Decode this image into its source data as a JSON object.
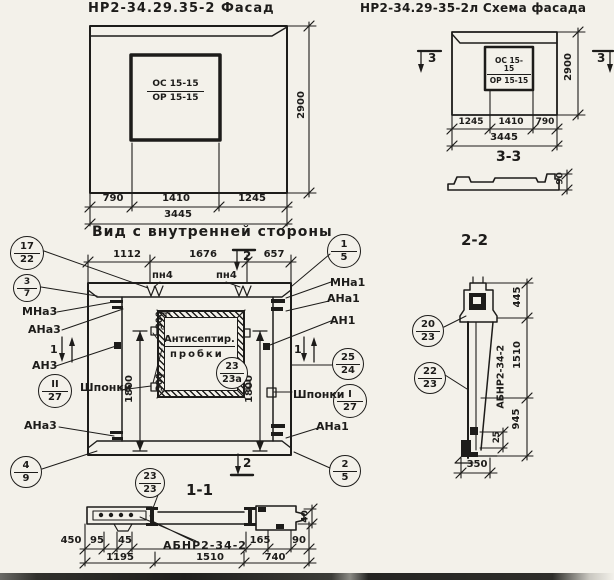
{
  "facade_view": {
    "title": "НР2-34.29.35-2 Фасад",
    "window_mark_top": "ОС 15-15",
    "window_mark_bottom": "ОР 15-15",
    "dim_height": "2900",
    "dims": [
      "790",
      "1410",
      "1245"
    ],
    "dim_total": "3445",
    "caption": "Вид с внутренней стороны"
  },
  "schema_view": {
    "title": "НР2-34.29-35-2л Схема фасада",
    "window_mark_top": "ОС 15-15",
    "window_mark_bottom": "ОР 15-15",
    "dim_height": "2900",
    "dims": [
      "1245",
      "1410",
      "790"
    ],
    "dim_total": "3445",
    "section_mark": "3",
    "section_title": "3-3",
    "section_thickness": "90"
  },
  "main_view": {
    "top_dims": [
      "1112",
      "1676",
      "657"
    ],
    "section_mark_2": "2",
    "section_mark_1": "1",
    "anchor_pn4": "пн4",
    "note_line1": "Антисептир.",
    "note_line2": "пробки",
    "dim_plug_top": "300",
    "dim_plug_bottom": "300",
    "dim_side_left": "1800",
    "dim_side_right": "1800",
    "label_mna3": "МНа3",
    "label_ana3_top": "АНа3",
    "label_an3": "АН3",
    "label_shponki_left": "Шпонки",
    "label_ana3_bottom": "АНа3",
    "label_mna1": "МНа1",
    "label_ana1_top": "АНа1",
    "label_an1": "АН1",
    "label_shponki_right": "Шпонки",
    "label_ana1_bottom": "АНа1",
    "section_title": "1-1"
  },
  "callouts": {
    "c17_22": {
      "top": "17",
      "bottom": "22"
    },
    "c3_7": {
      "top": "3",
      "bottom": "7"
    },
    "c2_27": {
      "top": "II",
      "bottom": "27"
    },
    "c4_9": {
      "top": "4",
      "bottom": "9"
    },
    "c1_5": {
      "top": "1",
      "bottom": "5"
    },
    "c25_24": {
      "top": "25",
      "bottom": "24"
    },
    "c1_27": {
      "top": "I",
      "bottom": "27"
    },
    "c2_5": {
      "top": "2",
      "bottom": "5"
    },
    "c23_23a": {
      "top": "23",
      "bottom": "23а"
    },
    "c23_23": {
      "top": "23",
      "bottom": "23"
    },
    "c20_23": {
      "top": "20",
      "bottom": "23"
    },
    "c22_23": {
      "top": "22",
      "bottom": "23"
    }
  },
  "section_1_1": {
    "dim_450": "450",
    "dim_95": "95",
    "dim_45": "45",
    "dim_165": "165",
    "dim_90": "90",
    "dim_40": "40",
    "beam_label": "АБНР2-34-2",
    "dims_bottom": [
      "1195",
      "1510",
      "740"
    ]
  },
  "section_2_2": {
    "title": "2-2",
    "beam_label": "АБНР2-34-2",
    "dim_445": "445",
    "dim_1510": "1510",
    "dim_945": "945",
    "dim_25": "25",
    "dim_350": "350"
  }
}
